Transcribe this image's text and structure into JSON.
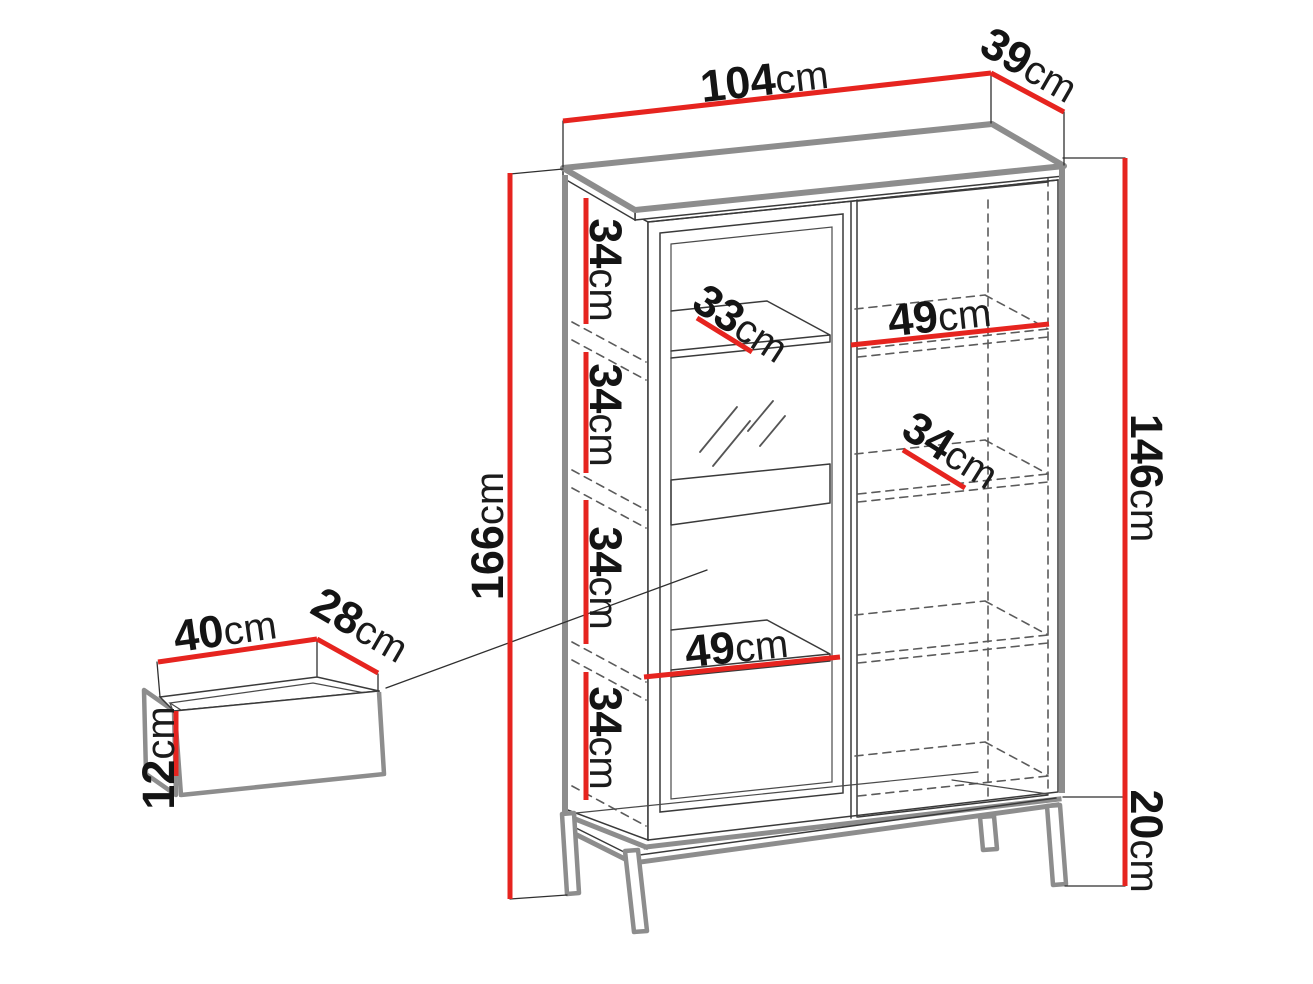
{
  "diagram": {
    "kind": "furniture-dimension-diagram",
    "unit": "cm",
    "background": "#ffffff"
  },
  "colors": {
    "dimension_red": "#e6241f",
    "outline_gray": "#8d8d8d",
    "line_dark": "#3a3a3a",
    "hidden_dash": "#5b5b5b",
    "text": "#141414"
  },
  "cabinet": {
    "width": {
      "value": "104",
      "unit": "cm"
    },
    "depth": {
      "value": "39",
      "unit": "cm"
    },
    "total_height": {
      "value": "166",
      "unit": "cm"
    },
    "body_height": {
      "value": "146",
      "unit": "cm"
    },
    "leg_height": {
      "value": "20",
      "unit": "cm"
    },
    "shelf_gaps": [
      {
        "value": "34",
        "unit": "cm"
      },
      {
        "value": "34",
        "unit": "cm"
      },
      {
        "value": "34",
        "unit": "cm"
      },
      {
        "value": "34",
        "unit": "cm"
      }
    ],
    "left_shelf_depth": {
      "value": "33",
      "unit": "cm"
    },
    "left_shelf_width": {
      "value": "49",
      "unit": "cm"
    },
    "right_shelf_width": {
      "value": "49",
      "unit": "cm"
    },
    "right_shelf_depth": {
      "value": "34",
      "unit": "cm"
    }
  },
  "drawer": {
    "width": {
      "value": "40",
      "unit": "cm"
    },
    "depth": {
      "value": "28",
      "unit": "cm"
    },
    "height": {
      "value": "12",
      "unit": "cm"
    }
  }
}
